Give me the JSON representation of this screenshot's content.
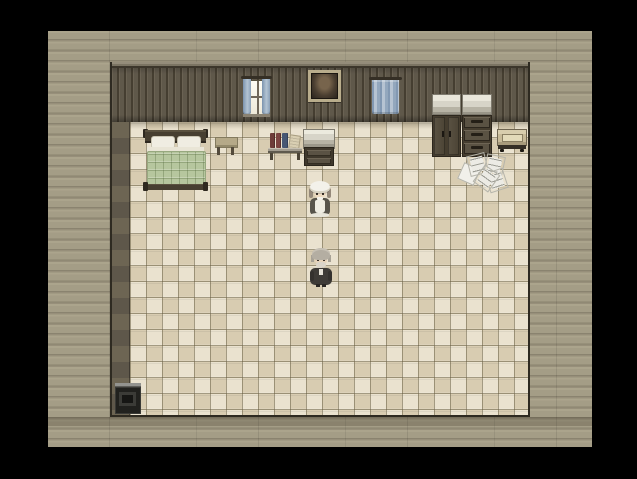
{
  "window": {
    "kind": "retro-rpg-game-window",
    "letterbox_color": "#000000"
  },
  "game_screen": {
    "width_px": 544,
    "height_px": 416,
    "offset_x": 48,
    "offset_y": 31,
    "description": "Top-down pixel-art bedroom interior with wooden plank surround, two NPCs standing on a checkered tile floor"
  },
  "palette": {
    "letterbox": "#000000",
    "outer_planks": "#a49d86",
    "outer_plank_line": "#88816d",
    "wall_dark": "#5f584a",
    "wall_line": "#453e31",
    "floor_light": "#eae2cf",
    "floor_dark": "#d8ccb1",
    "floor_grid": "#685e44",
    "bed_frame": "#473f31",
    "bed_blanket_green": "#b6c69e",
    "curtain_blue": "#8ea2ba",
    "furniture_dark_wood": "#453d2f",
    "furniture_marble_top": "#d7d4c8",
    "paper_white": "#ecebe5",
    "stove_iron": "#21211e"
  },
  "room": {
    "name": "bedroom",
    "objects": [
      {
        "id": "window-left",
        "label": "window with parted blue curtains"
      },
      {
        "id": "portrait",
        "label": "framed portrait hanging on wall"
      },
      {
        "id": "window-right",
        "label": "window with closed blue curtain"
      },
      {
        "id": "bed",
        "label": "double bed with white pillows and green quilt"
      },
      {
        "id": "side-table",
        "label": "small wooden side table"
      },
      {
        "id": "book-shelf",
        "label": "wall shelf with red and blue books"
      },
      {
        "id": "counter",
        "label": "counter cabinet with two drawers"
      },
      {
        "id": "wardrobe",
        "label": "two-door wardrobe with stone top"
      },
      {
        "id": "dresser",
        "label": "three-drawer dresser with stone top"
      },
      {
        "id": "radio-table",
        "label": "small beige radio cart"
      },
      {
        "id": "papers",
        "label": "papers scattered on the floor"
      },
      {
        "id": "stove",
        "label": "black iron stove in the corner"
      }
    ],
    "characters": [
      {
        "id": "maid",
        "label": "maid NPC in white bonnet and apron",
        "facing": "down"
      },
      {
        "id": "old-man",
        "label": "old man NPC with white beard in dark coat",
        "facing": "down"
      }
    ]
  }
}
